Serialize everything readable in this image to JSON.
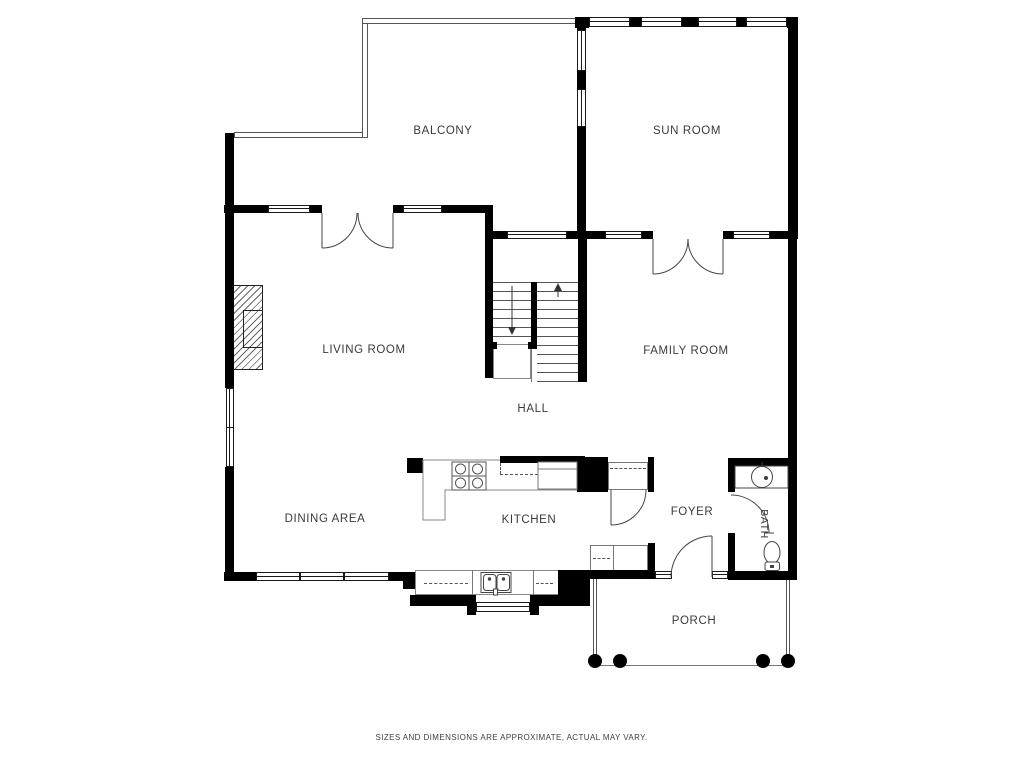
{
  "plan": {
    "rooms": [
      {
        "id": "balcony",
        "label": "BALCONY"
      },
      {
        "id": "sun-room",
        "label": "SUN ROOM"
      },
      {
        "id": "living-room",
        "label": "LIVING ROOM"
      },
      {
        "id": "family-room",
        "label": "FAMILY ROOM"
      },
      {
        "id": "hall",
        "label": "HALL"
      },
      {
        "id": "dining-area",
        "label": "DINING AREA"
      },
      {
        "id": "kitchen",
        "label": "KITCHEN"
      },
      {
        "id": "foyer",
        "label": "FOYER"
      },
      {
        "id": "bath",
        "label": "BATH"
      },
      {
        "id": "porch",
        "label": "PORCH"
      }
    ],
    "disclaimer": "SIZES AND DIMENSIONS ARE APPROXIMATE, ACTUAL MAY VARY.",
    "colors": {
      "wall": "#000000",
      "thin_line": "#555555",
      "text": "#3a3a3a",
      "background": "#ffffff"
    },
    "fixtures": [
      "fireplace",
      "stairs",
      "stove",
      "refrigerator",
      "kitchen-sink",
      "bathroom-sink",
      "toilet",
      "porch-columns"
    ]
  }
}
